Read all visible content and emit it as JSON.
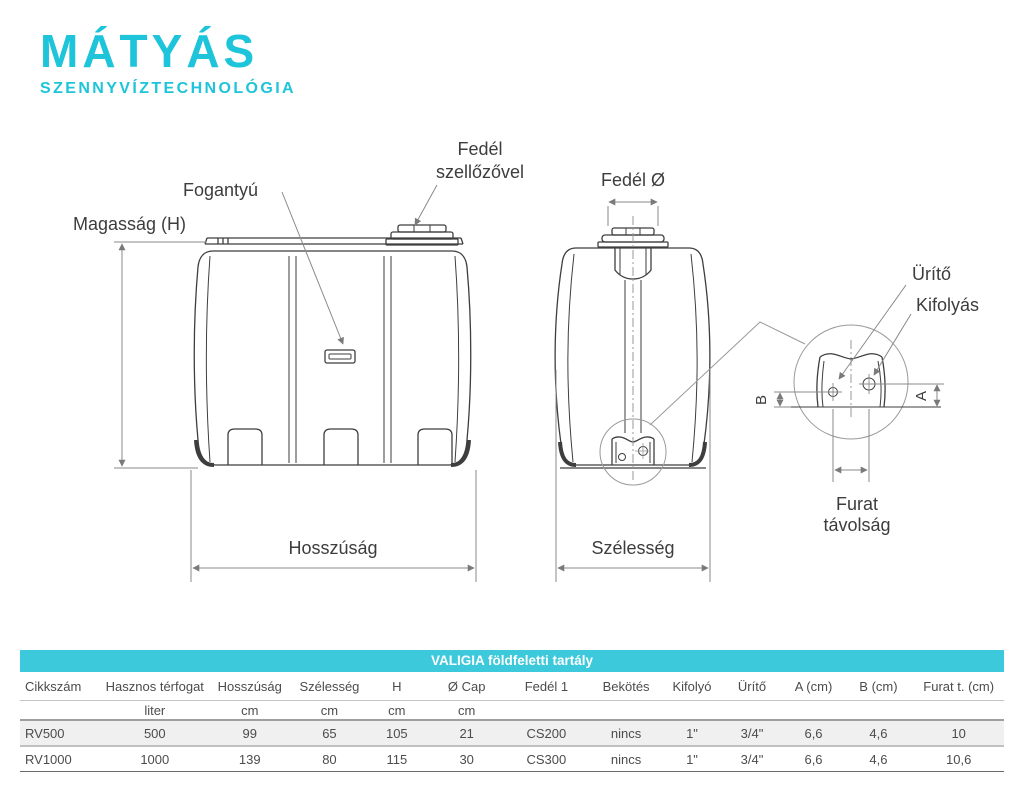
{
  "colors": {
    "accent": "#1ec4d9",
    "table_band": "#3bc9db",
    "line_dark": "#3e3e3e",
    "line_gray": "#8a8a8a",
    "text": "#3d3d3d"
  },
  "logo": {
    "title": "MÁTYÁS",
    "subtitle": "SZENNYVÍZTECHNOLÓGIA"
  },
  "diagram": {
    "labels": {
      "magassag": "Magasság (H)",
      "fogantyu": "Fogantyú",
      "fedel_line1": "Fedél",
      "fedel_line2": "szellőzővel",
      "fedel_o": "Fedél Ø",
      "hosszusag": "Hosszúság",
      "szelesseg": "Szélesség",
      "urito": "Ürítő",
      "kifolyas": "Kifolyás",
      "furat_line1": "Furat",
      "furat_line2": "távolság",
      "dim_a": "A",
      "dim_b": "B"
    }
  },
  "table": {
    "title": "VALIGIA földfeletti tartály",
    "columns": [
      "Cikkszám",
      "Hasznos térfogat",
      "Hosszúság",
      "Szélesség",
      "H",
      "Ø Cap",
      "Fedél 1",
      "Bekötés",
      "Kifolyó",
      "Ürítő",
      "A (cm)",
      "B (cm)",
      "Furat t. (cm)"
    ],
    "units": [
      "",
      "liter",
      "cm",
      "cm",
      "cm",
      "cm",
      "",
      "",
      "",
      "",
      "",
      "",
      ""
    ],
    "rows": [
      {
        "cells": [
          "RV500",
          "500",
          "99",
          "65",
          "105",
          "21",
          "CS200",
          "nincs",
          "1\"",
          "3/4\"",
          "6,6",
          "4,6",
          "10"
        ]
      },
      {
        "cells": [
          "RV1000",
          "1000",
          "139",
          "80",
          "115",
          "30",
          "CS300",
          "nincs",
          "1\"",
          "3/4\"",
          "6,6",
          "4,6",
          "10,6"
        ]
      }
    ]
  }
}
